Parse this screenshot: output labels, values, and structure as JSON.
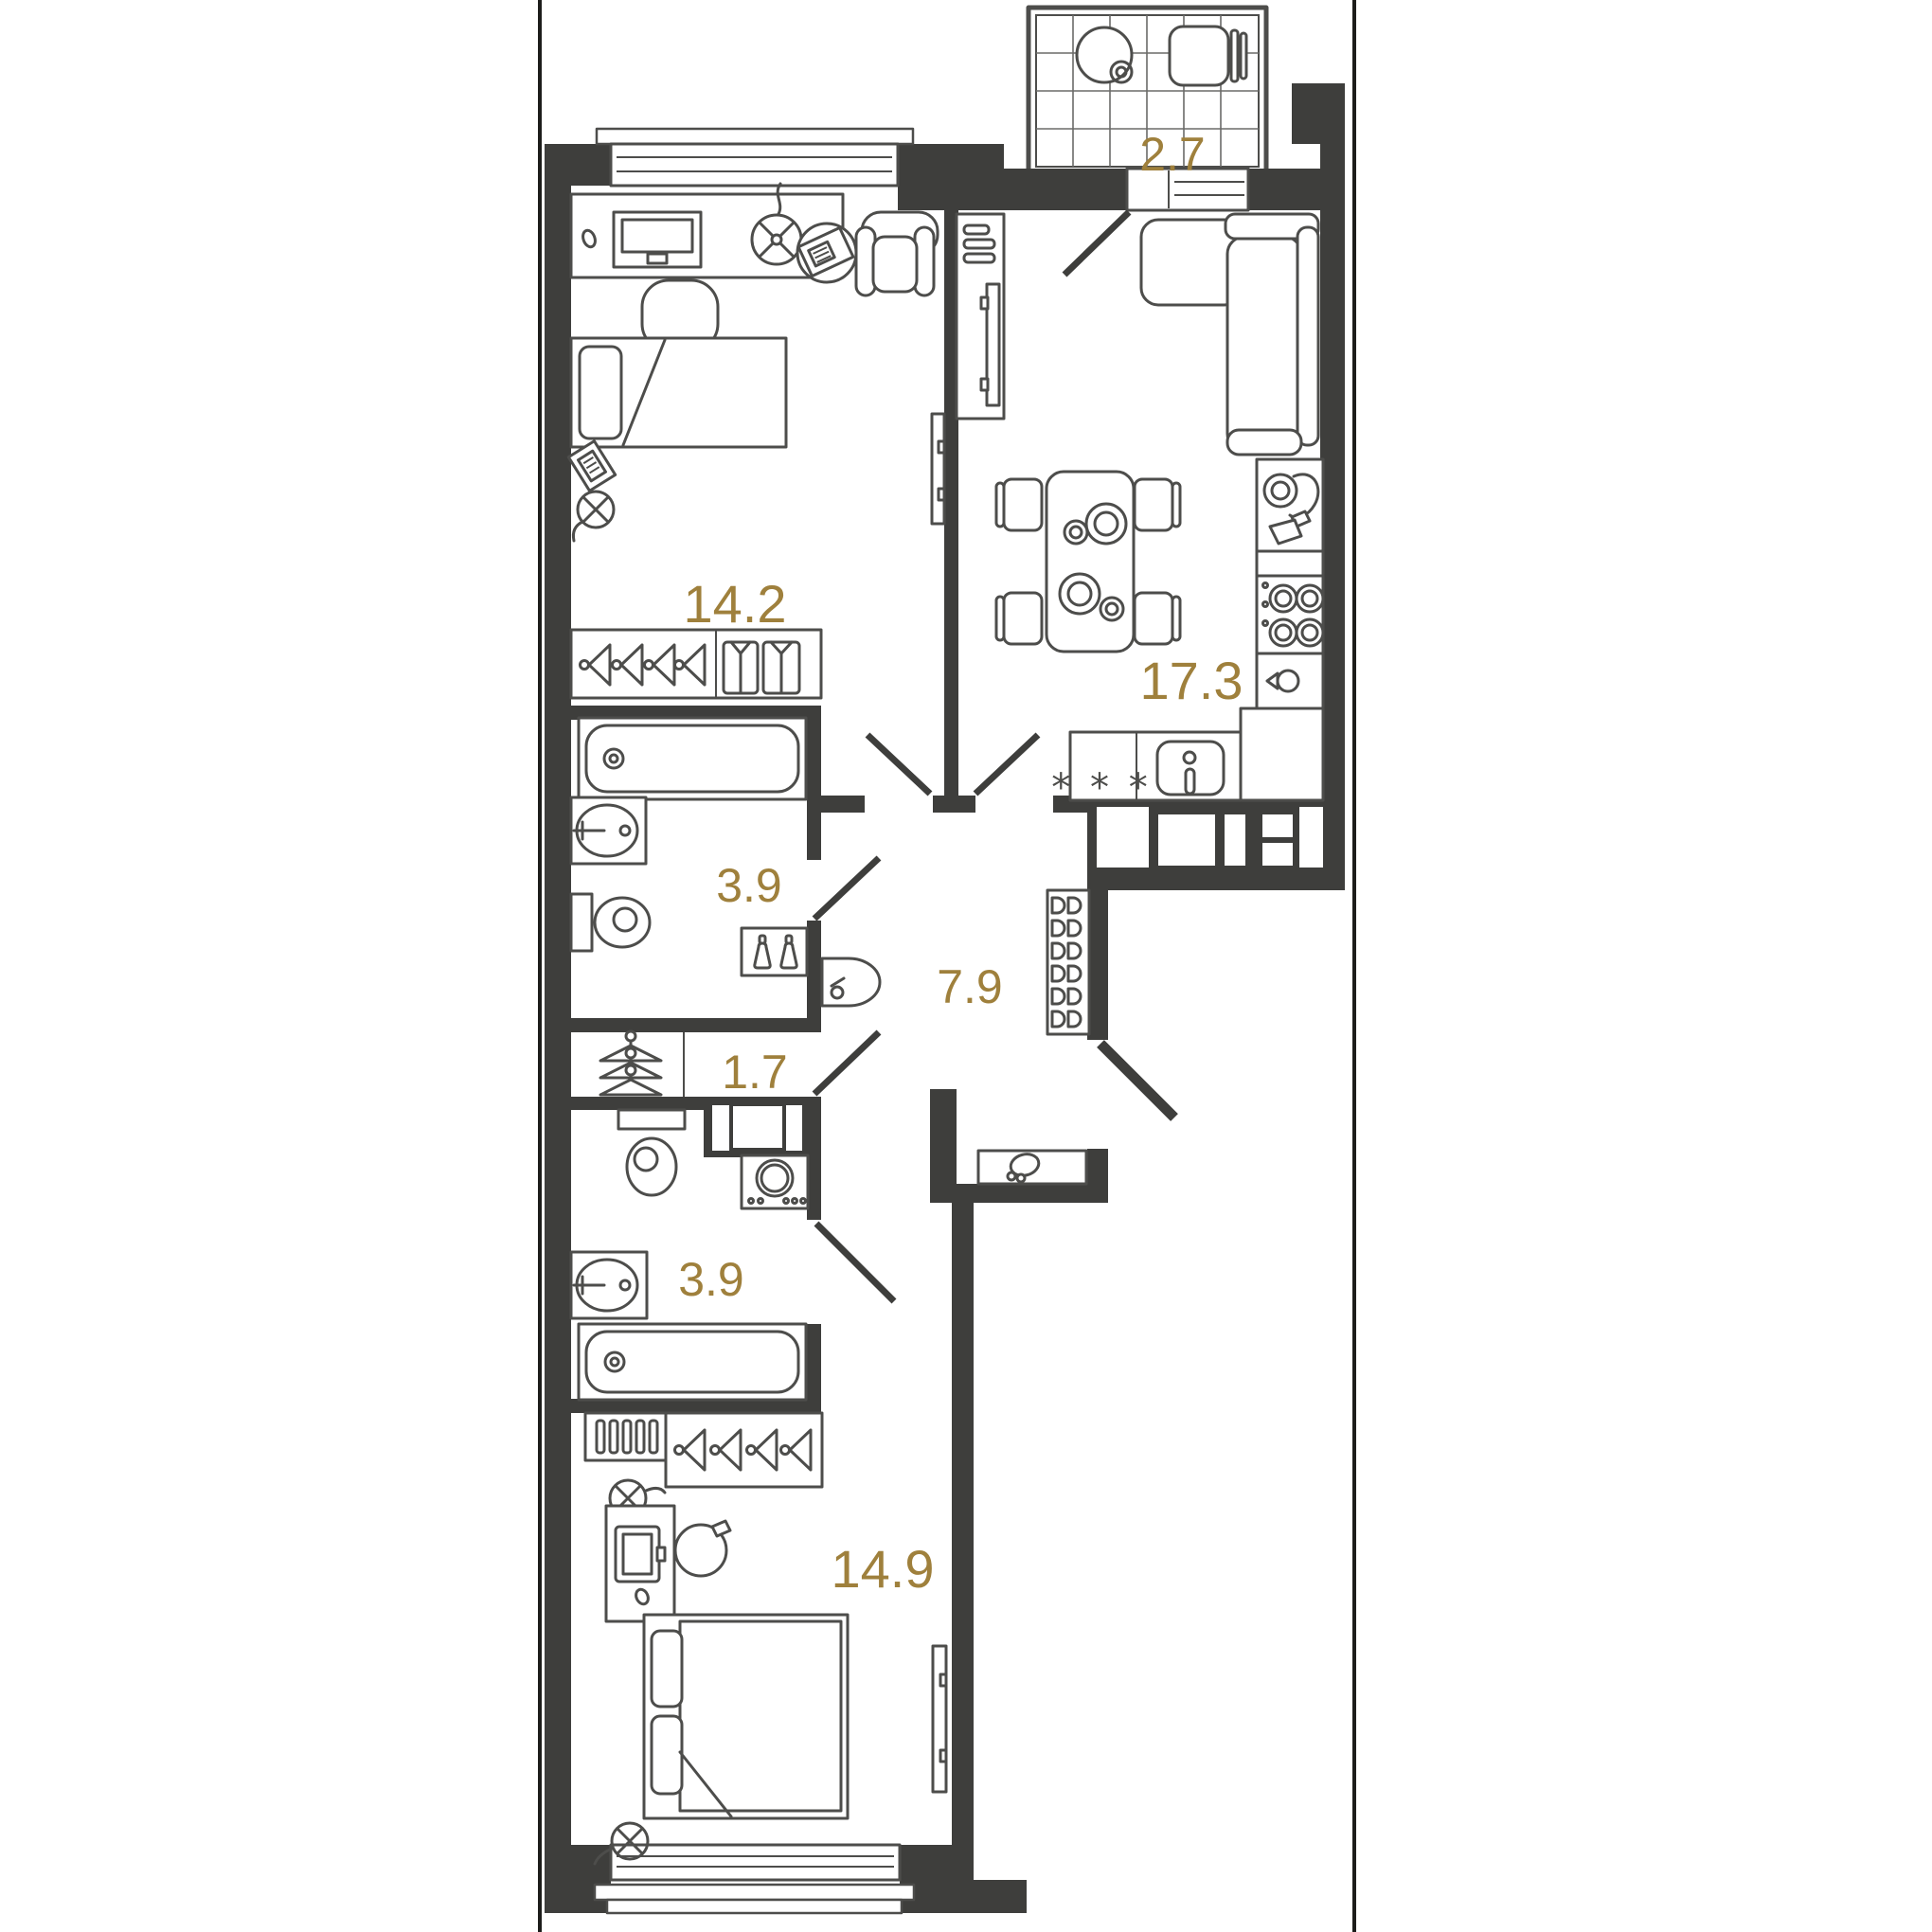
{
  "page": {
    "background": "#ffffff",
    "frame_color": "#1d1d1b"
  },
  "plan": {
    "wall_color": "#3E3E3C",
    "furniture_color": "#4D4D4B",
    "area_label_color": "#9F803C",
    "kitchen": {
      "dishwasher_symbol": "* * *"
    },
    "rooms": [
      {
        "id": "balcony",
        "area": "2.7"
      },
      {
        "id": "room-top",
        "area": "14.2"
      },
      {
        "id": "kitchen-living",
        "area": "17.3"
      },
      {
        "id": "bathroom-top",
        "area": "3.9"
      },
      {
        "id": "hallway",
        "area": "7.9"
      },
      {
        "id": "closet",
        "area": "1.7"
      },
      {
        "id": "bathroom-bottom",
        "area": "3.9"
      },
      {
        "id": "bedroom-bottom",
        "area": "14.9"
      }
    ]
  }
}
